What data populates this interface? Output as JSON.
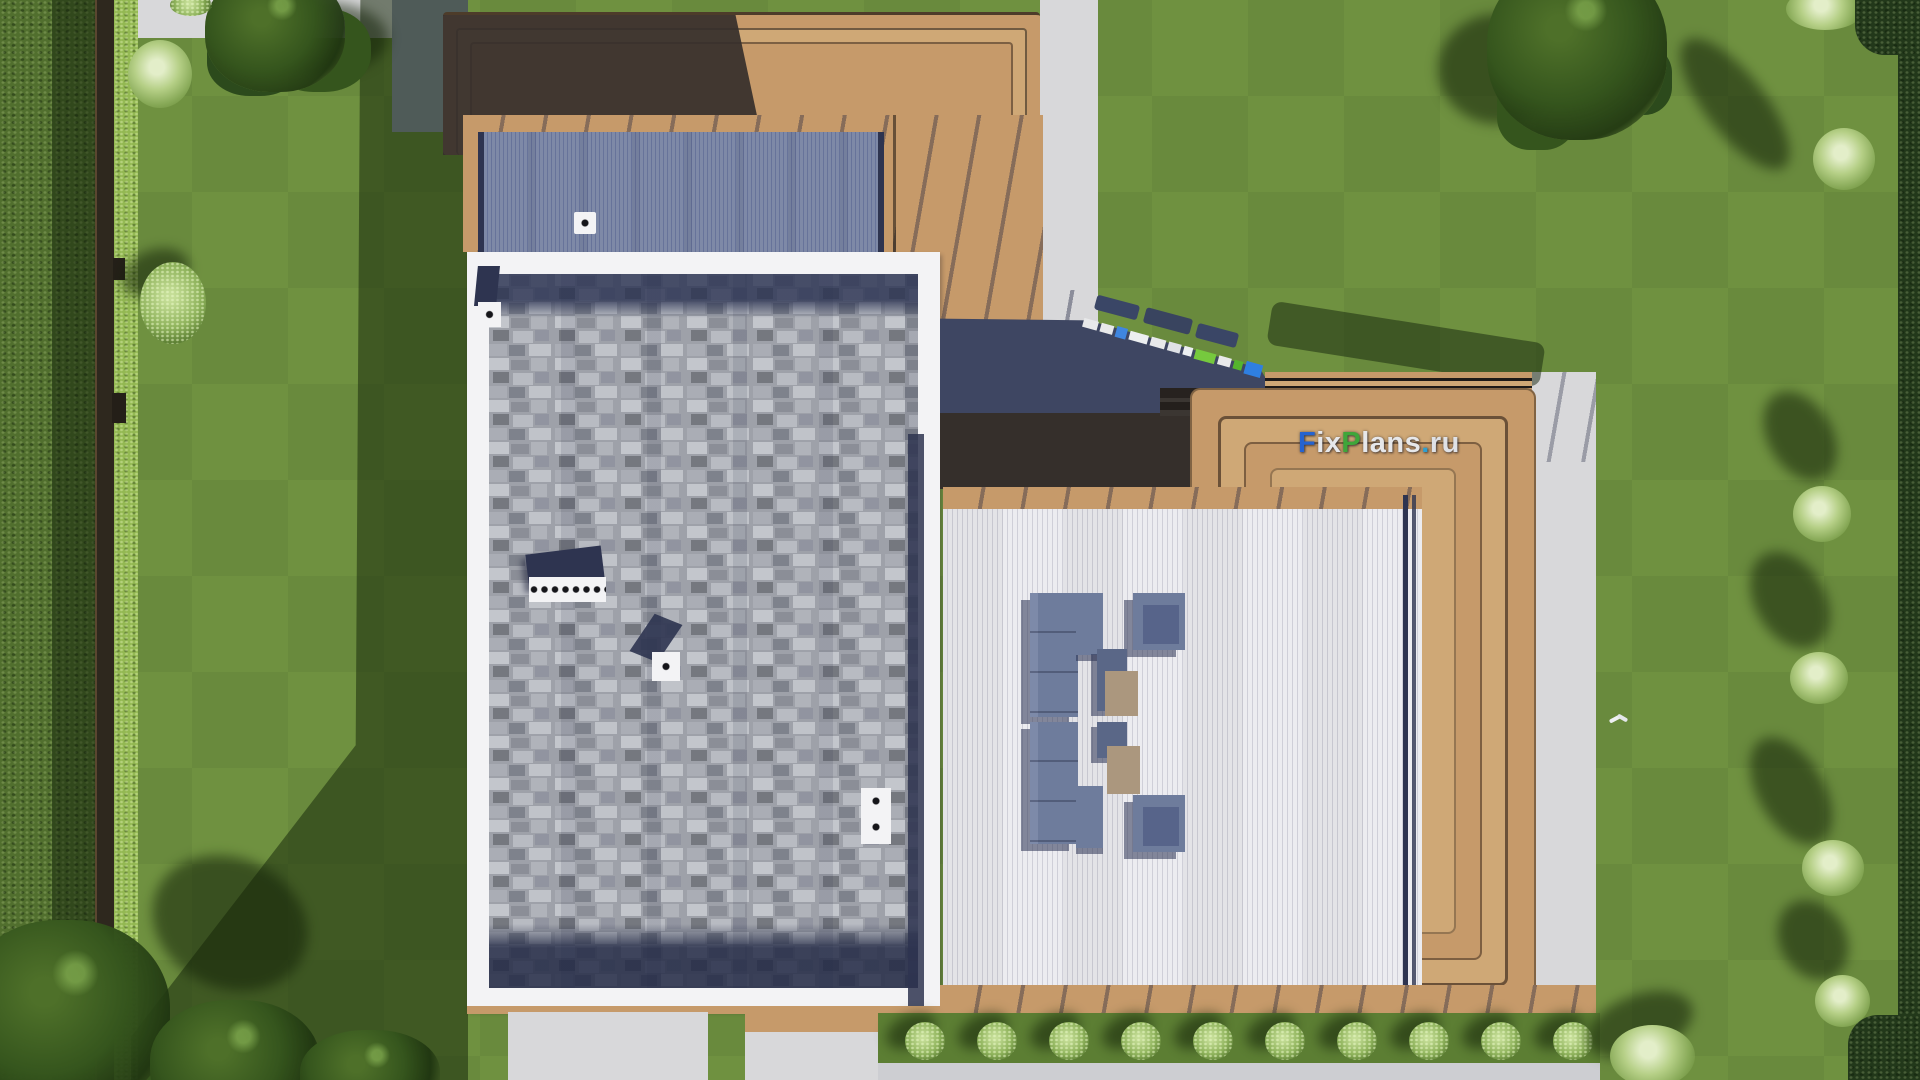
{
  "watermark": {
    "text": "FixPlans.ru",
    "parts": [
      {
        "text": "F",
        "color": "#2563cf"
      },
      {
        "text": "ix",
        "color": "#e6e7ea"
      },
      {
        "text": "P",
        "color": "#3fa63a"
      },
      {
        "text": "lans",
        "color": "#e6e7ea"
      },
      {
        "text": ".",
        "color": "#2f9fd0"
      },
      {
        "text": "ru",
        "color": "#dfe1e6"
      }
    ]
  },
  "colors": {
    "grass": "#6f9140",
    "grass_band": "#5c7e33",
    "shadow_green": "rgba(18,32,8,0.55)",
    "hedge": "#516f2e",
    "hedge_bright": "#93b852",
    "fence": "#2e281e",
    "concrete": "#d8d8da",
    "concrete_shade": "#8e95ad",
    "tan": "#c69a6a",
    "tan_light": "#cfa876",
    "charcoal": "#352f2b",
    "charcoal_light": "#4a443f",
    "navy": "#3e4662",
    "navy_deep": "#2e3450",
    "white_frame": "#f3f3f5",
    "corrugated": "#7e89a7",
    "corrugated_line": "#67739a",
    "deck_white": "#ececf0",
    "deck_line": "#cfcfd8",
    "furniture": "#6e7c9c",
    "furniture_light": "#7d8aa9",
    "furniture_shadow": "rgba(43,51,84,0.55)",
    "table_tan": "#ab977e",
    "tree_dark": "#35551d",
    "tree_mid": "#4e7029",
    "bush_light": "#b5cf86",
    "flower": "#e3eec9"
  }
}
